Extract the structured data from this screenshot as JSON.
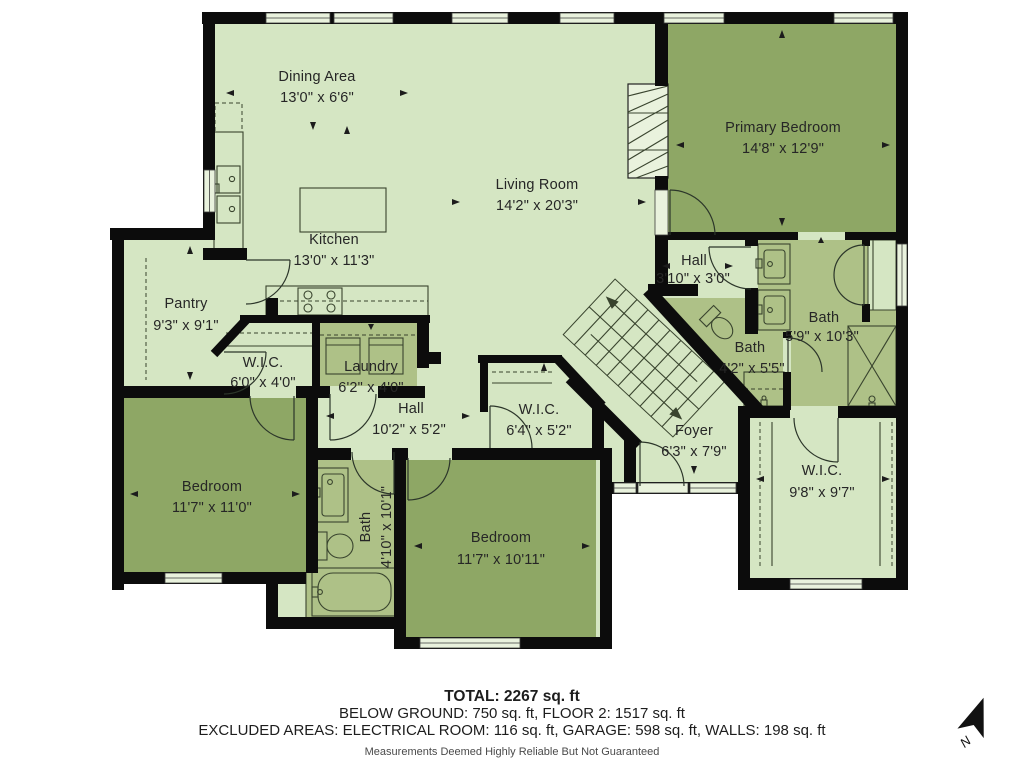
{
  "plan_title": "Floor plan",
  "colors": {
    "room_light": "#d5e6c3",
    "room_medium": "#aec187",
    "room_dark": "#8ea765",
    "walls": "#0c0c0c",
    "background": "#ffffff"
  },
  "rooms": [
    {
      "id": "dining",
      "name": "Dining Area",
      "dims": "13'0\" x 6'6\"",
      "shade": "light"
    },
    {
      "id": "living",
      "name": "Living Room",
      "dims": "14'2\" x 20'3\"",
      "shade": "light"
    },
    {
      "id": "primary",
      "name": "Primary Bedroom",
      "dims": "14'8\" x 12'9\"",
      "shade": "dark"
    },
    {
      "id": "kitchen",
      "name": "Kitchen",
      "dims": "13'0\" x 11'3\"",
      "shade": "light"
    },
    {
      "id": "pantry",
      "name": "Pantry",
      "dims": "9'3\" x 9'1\"",
      "shade": "light"
    },
    {
      "id": "hall-upper",
      "name": "Hall",
      "dims": "3'10\" x 3'0\"",
      "shade": "light"
    },
    {
      "id": "bath-primary",
      "name": "Bath",
      "dims": "5'9\" x 10'3\"",
      "shade": "medium"
    },
    {
      "id": "wic-small",
      "name": "W.I.C.",
      "dims": "6'0\" x 4'0\"",
      "shade": "light"
    },
    {
      "id": "laundry",
      "name": "Laundry",
      "dims": "6'2\" x 4'0\"",
      "shade": "medium"
    },
    {
      "id": "bath-powder",
      "name": "Bath",
      "dims": "4'2\" x 5'5\"",
      "shade": "medium"
    },
    {
      "id": "hall-lower",
      "name": "Hall",
      "dims": "10'2\" x 5'2\"",
      "shade": "light"
    },
    {
      "id": "wic-mid",
      "name": "W.I.C.",
      "dims": "6'4\" x 5'2\"",
      "shade": "light"
    },
    {
      "id": "foyer",
      "name": "Foyer",
      "dims": "6'3\" x 7'9\"",
      "shade": "light"
    },
    {
      "id": "bedroom-left",
      "name": "Bedroom",
      "dims": "11'7\" x 11'0\"",
      "shade": "dark"
    },
    {
      "id": "bath-hall",
      "name": "Bath",
      "dims": "4'10\" x 10'1\"",
      "shade": "medium"
    },
    {
      "id": "bedroom-mid",
      "name": "Bedroom",
      "dims": "11'7\" x 10'11\"",
      "shade": "dark"
    },
    {
      "id": "wic-primary",
      "name": "W.I.C.",
      "dims": "9'8\" x 9'7\"",
      "shade": "light"
    }
  ],
  "footer": {
    "total": "TOTAL: 2267 sq. ft",
    "line2": "BELOW GROUND: 750 sq. ft, FLOOR 2: 1517 sq. ft",
    "line3": "EXCLUDED AREAS: ELECTRICAL ROOM: 116 sq. ft, GARAGE: 598 sq. ft, WALLS: 198 sq. ft",
    "disclaimer": "Measurements Deemed Highly Reliable But Not Guaranteed"
  },
  "compass": {
    "label": "N"
  }
}
